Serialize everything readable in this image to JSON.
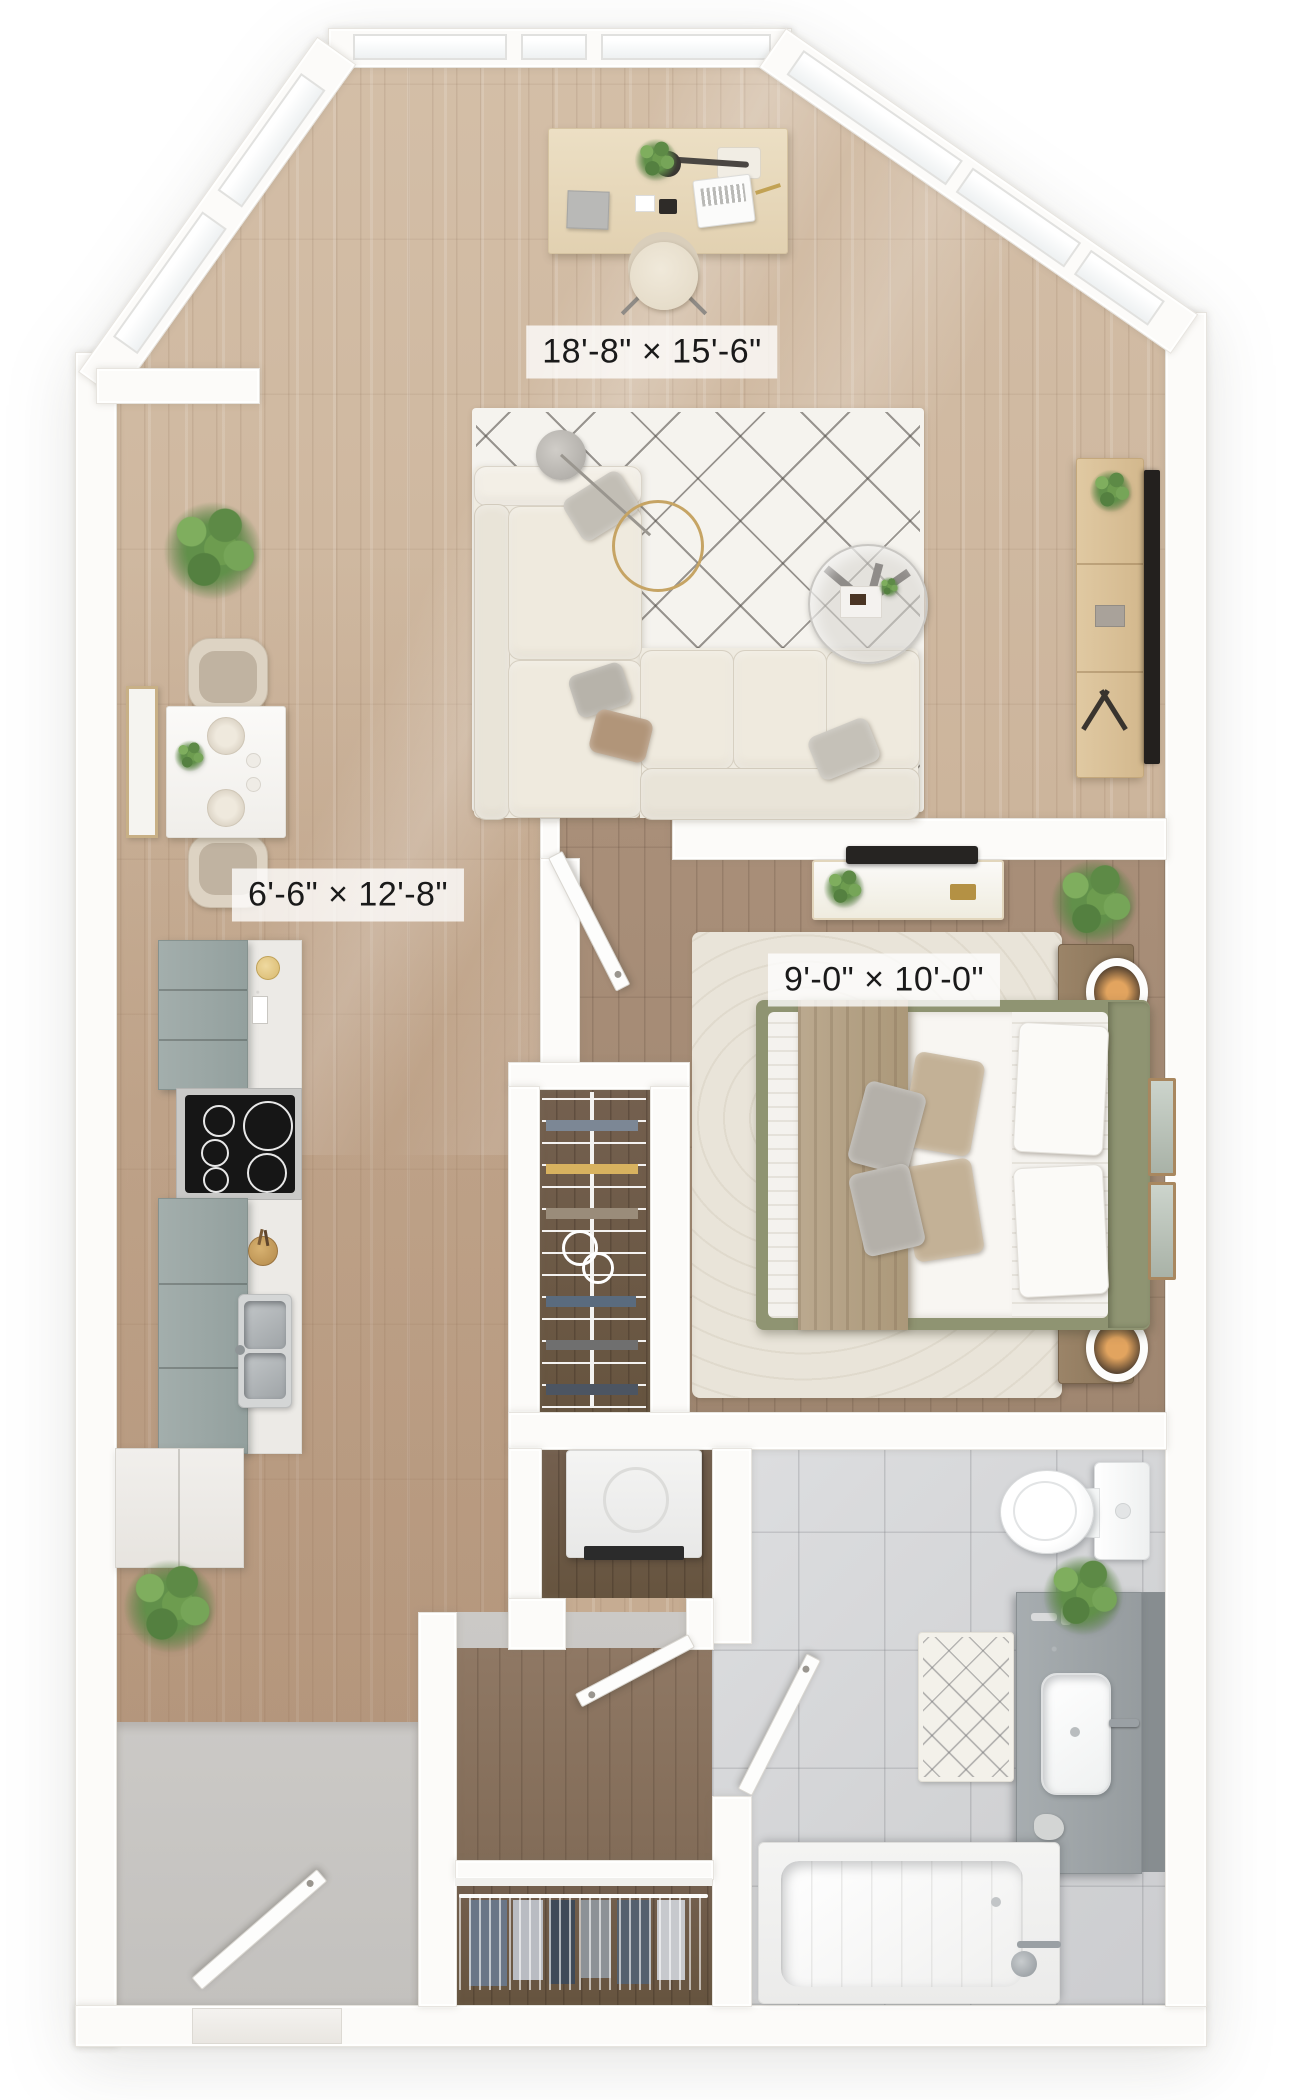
{
  "floorplan": {
    "view": "3d-top-down-apartment-floor-plan",
    "rooms": [
      {
        "id": "living-room",
        "dimensions": "18'-8\" × 15'-6\""
      },
      {
        "id": "kitchen",
        "dimensions": "6'-6\" × 12'-8\""
      },
      {
        "id": "bedroom",
        "dimensions": "9'-0\" × 10'-0\""
      }
    ],
    "colors": {
      "wall": "#fcfbf9",
      "floor_living_wood": "#cbb39a",
      "floor_bedroom_wood": "#a18870",
      "floor_closet_wood": "#6f5b4c",
      "floor_bathroom_tile": "#d4d5d7",
      "floor_entry_gray": "#c7c5c2",
      "kitchen_cabinet_gray": "#9aa5a4",
      "bed_frame_sage": "#8f9472",
      "living_rug": "#f5f3ee",
      "bedroom_rug": "#e9e4d9",
      "plant_green": "#61904a",
      "label_background": "rgba(255,255,255,0.78)",
      "label_text": "#1a1a1a"
    }
  }
}
